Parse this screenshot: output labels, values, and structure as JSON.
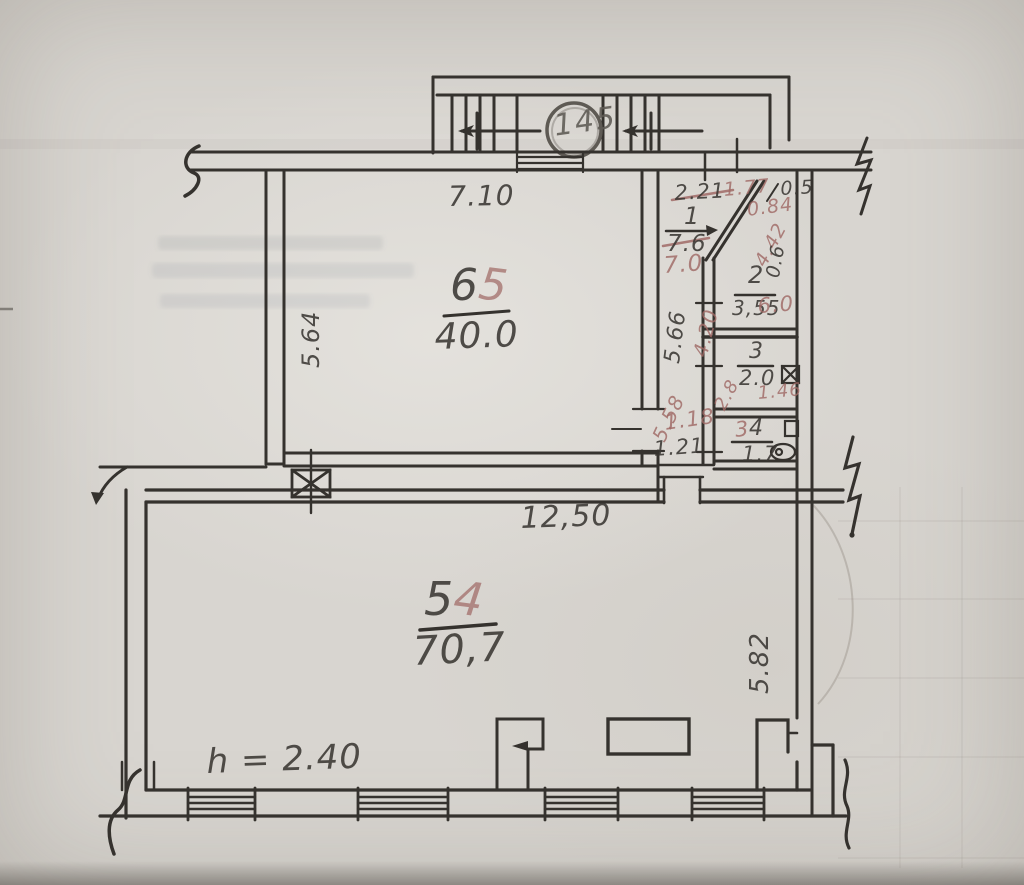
{
  "title": "Hand-drawn apartment floor plan sketch",
  "colors": {
    "paper": "#d8d5d0",
    "ink": "#35322e",
    "red_pencil": "#a06a66"
  },
  "stairs": {
    "label": "145"
  },
  "rooms": {
    "r65": {
      "num_main": "6",
      "num_red": "5",
      "area": "40.0"
    },
    "r54": {
      "num_main": "5",
      "num_red": "4",
      "area": "70,7"
    },
    "r1": {
      "num": "1",
      "area_old": "7.6",
      "area_new": "7.0"
    },
    "r2": {
      "num": "2",
      "area_old": "3,55",
      "area_new": "6.0"
    },
    "r3": {
      "num": "3",
      "area": "2.0"
    },
    "r4": {
      "num_old": "3",
      "num": "4",
      "area": "1.7"
    }
  },
  "dims": {
    "top_width": "7.10",
    "left_height": "5.64",
    "bottom_width": "12,50",
    "right_height": "5.82",
    "corridor_len": "5.66",
    "corridor_len_red": "5.58",
    "hall_old": "2.21",
    "hall_new": "1.77",
    "d05": "0.5",
    "d084": "0.84",
    "d442": "4.42",
    "d06": "0.6",
    "d420": "4.20",
    "d28": "2.8",
    "d146": "1.46",
    "d118": "1.18",
    "d121": "1.21",
    "height_note": "h = 2.40"
  }
}
